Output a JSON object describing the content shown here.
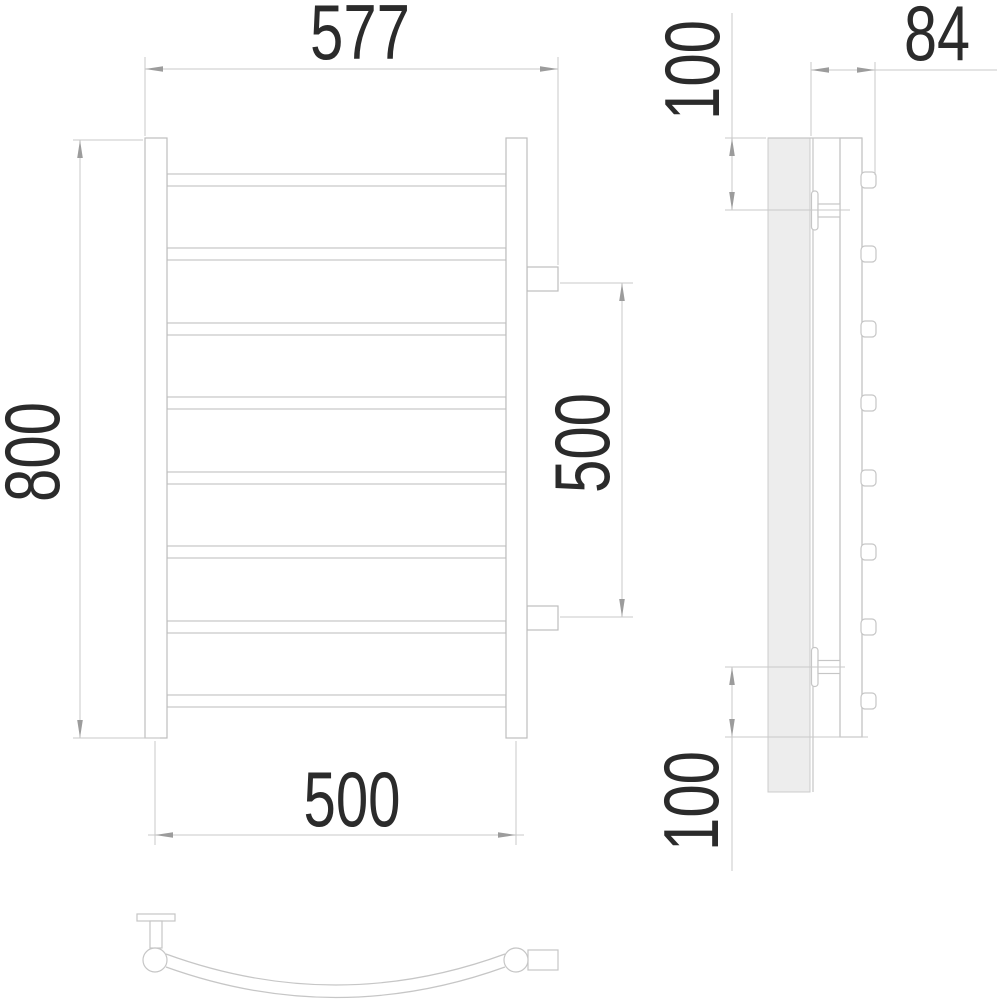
{
  "drawing": {
    "type": "technical-dimension-drawing",
    "subject": "curved towel rail with 8 horizontal bars, front view, side view and top arc view",
    "units": "mm",
    "front_view": {
      "overall_width_label": "577",
      "overall_height_label": "800",
      "connection_spacing_label": "500",
      "rail_center_spacing_label": "500",
      "bar_count": 8
    },
    "side_view": {
      "top_bracket_offset_label": "100",
      "depth_label": "84",
      "bottom_bracket_offset_label": "100"
    },
    "colors": {
      "background": "#ffffff",
      "outline": "#c6c6c6",
      "plate_fill": "#ededed",
      "dimension_line": "#c9c9c9",
      "arrow": "#9c9c9c",
      "label_text": "#2b2b2b"
    }
  }
}
